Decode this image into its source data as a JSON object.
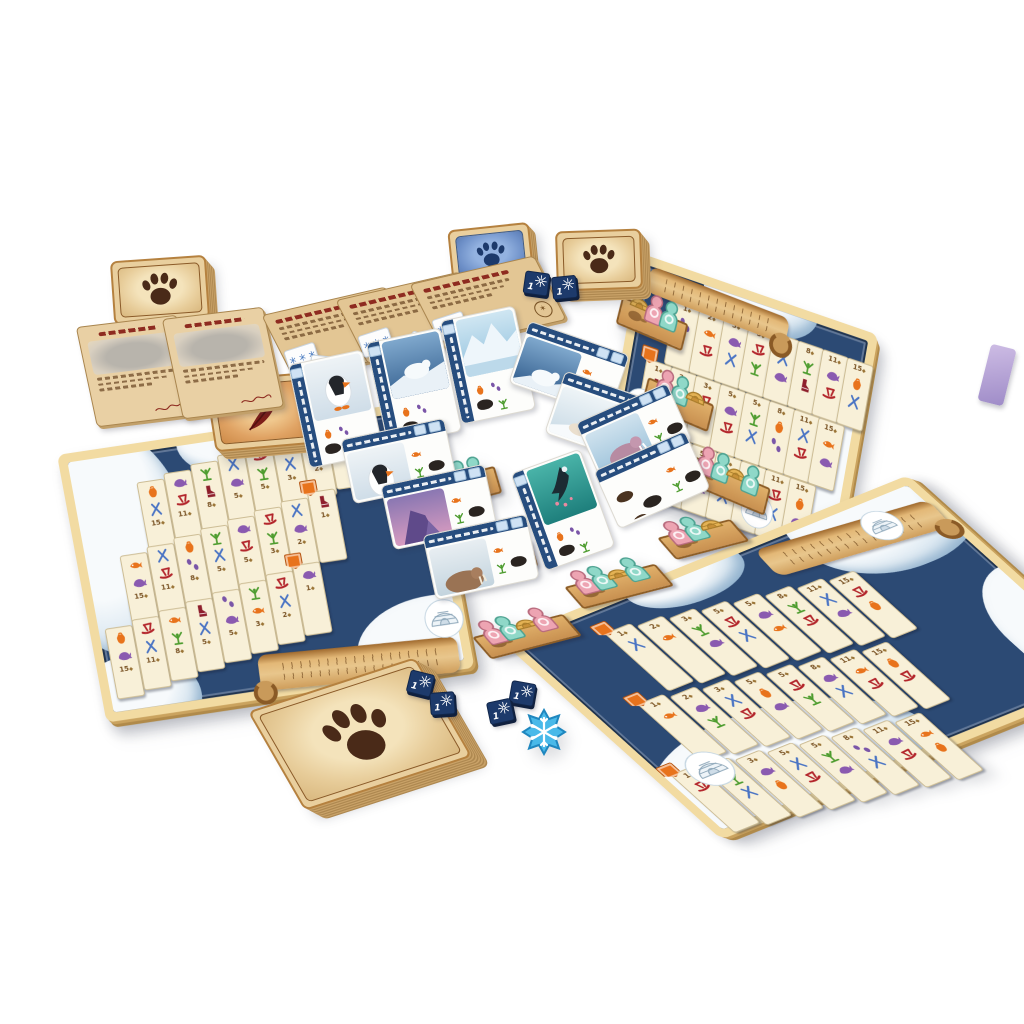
{
  "palette": {
    "board_frame": "#f2dba2",
    "water": "#2c4a74",
    "strip_bg": "#f8f0d8",
    "wood": "#d49e58",
    "sled": "#b3252b",
    "skis": "#4a74c4",
    "fish": "#e8731c",
    "whale": "#8a5ab0",
    "catch": "#4d9c2e",
    "boot": "#8e1f2c",
    "steps": "#7a55a8",
    "bag": "#e8731c",
    "paw": "#4a2a18",
    "feather": "#7e1f1a",
    "blue_emblem": "#1d3a6b",
    "meeple_pink": "#eda4b2",
    "meeple_mint": "#8fd8c8",
    "meeple_gold": "#e4b254",
    "navy_token": "#1d3a6b",
    "snow_token": "#49b9e9"
  },
  "decks": {
    "paw_top_left": {
      "back_icon": "paw-icon"
    },
    "paw_right": {
      "back_icon": "paw-icon"
    },
    "paw_bottom": {
      "back_icon": "paw-icon"
    },
    "feather": {
      "back_icon": "feather-icon"
    },
    "blue": {
      "back_icon": "blue-deck-emblem-icon"
    }
  },
  "guide_cards": [
    {
      "art": "walrus-sketch"
    },
    {
      "art": "seal-sketch"
    }
  ],
  "objective_cards": [
    {
      "stamp_icon": "snowflake-icon",
      "mini_snowflake_cards": 2
    },
    {
      "stamp_icon": "snowflake-icon",
      "mini_snowflake_cards": 3
    },
    {
      "stamp_icon": "snowflake-icon",
      "mini_snowflake_cards": 3
    }
  ],
  "market_cards": [
    {
      "art": "puffin"
    },
    {
      "art": "polar-bear"
    },
    {
      "art": "iceberg"
    }
  ],
  "boards": {
    "left": {
      "rows": [
        [
          {
            "v": 15,
            "i": [
              "bag",
              "skis"
            ]
          },
          {
            "v": 11,
            "i": [
              "whale",
              "sled"
            ]
          },
          {
            "v": 8,
            "i": [
              "catch",
              "boot"
            ]
          },
          {
            "v": 5,
            "i": [
              "skis",
              "whale"
            ]
          },
          {
            "v": 5,
            "i": [
              "sled",
              "catch"
            ]
          },
          {
            "v": 3,
            "i": [
              "whale",
              "skis"
            ]
          },
          {
            "v": 2,
            "i": [
              "fish",
              "sled"
            ]
          },
          {
            "v": 1,
            "i": [
              "steps"
            ]
          }
        ],
        [
          {
            "v": 15,
            "i": [
              "fish",
              "whale"
            ]
          },
          {
            "v": 11,
            "i": [
              "skis",
              "sled"
            ]
          },
          {
            "v": 8,
            "i": [
              "bag",
              "steps"
            ]
          },
          {
            "v": 5,
            "i": [
              "catch",
              "skis"
            ]
          },
          {
            "v": 5,
            "i": [
              "whale",
              "sled"
            ]
          },
          {
            "v": 3,
            "i": [
              "sled",
              "catch"
            ]
          },
          {
            "v": 2,
            "i": [
              "skis",
              "whale"
            ]
          },
          {
            "v": 1,
            "i": [
              "boot"
            ]
          }
        ],
        [
          {
            "v": 15,
            "i": [
              "bag",
              "whale"
            ]
          },
          {
            "v": 11,
            "i": [
              "sled",
              "skis"
            ]
          },
          {
            "v": 8,
            "i": [
              "fish",
              "catch"
            ]
          },
          {
            "v": 5,
            "i": [
              "boot",
              "skis"
            ]
          },
          {
            "v": 5,
            "i": [
              "steps",
              "whale"
            ]
          },
          {
            "v": 3,
            "i": [
              "catch",
              "fish"
            ]
          },
          {
            "v": 2,
            "i": [
              "sled",
              "skis"
            ]
          },
          {
            "v": 1,
            "i": [
              "whale"
            ]
          }
        ]
      ],
      "ledges": [
        [
          "pink",
          "mint"
        ],
        [
          "pink",
          "mint",
          "mint"
        ],
        [
          "pink",
          "mint",
          "gold"
        ]
      ],
      "cards": [
        {
          "art": "puffin"
        },
        {
          "art": "purple-rock"
        },
        {
          "art": "walrus"
        }
      ]
    },
    "right": {
      "rows": [
        [
          {
            "v": 1,
            "i": [
              "steps"
            ]
          },
          {
            "v": 2,
            "i": [
              "fish",
              "sled"
            ]
          },
          {
            "v": 3,
            "i": [
              "whale",
              "skis"
            ]
          },
          {
            "v": 5,
            "i": [
              "sled",
              "catch"
            ]
          },
          {
            "v": 5,
            "i": [
              "skis",
              "whale"
            ]
          },
          {
            "v": 8,
            "i": [
              "catch",
              "boot"
            ]
          },
          {
            "v": 11,
            "i": [
              "whale",
              "sled"
            ]
          },
          {
            "v": 15,
            "i": [
              "bag",
              "skis"
            ]
          }
        ],
        [
          {
            "v": 1,
            "i": [
              "boot"
            ]
          },
          {
            "v": 2,
            "i": [
              "skis",
              "whale"
            ]
          },
          {
            "v": 3,
            "i": [
              "sled",
              "catch"
            ]
          },
          {
            "v": 5,
            "i": [
              "whale",
              "sled"
            ]
          },
          {
            "v": 5,
            "i": [
              "catch",
              "skis"
            ]
          },
          {
            "v": 8,
            "i": [
              "bag",
              "steps"
            ]
          },
          {
            "v": 11,
            "i": [
              "skis",
              "sled"
            ]
          },
          {
            "v": 15,
            "i": [
              "fish",
              "whale"
            ]
          }
        ],
        [
          {
            "v": 1,
            "i": [
              "whale"
            ]
          },
          {
            "v": 2,
            "i": [
              "sled",
              "skis"
            ]
          },
          {
            "v": 3,
            "i": [
              "catch",
              "fish"
            ]
          },
          {
            "v": 5,
            "i": [
              "steps",
              "whale"
            ]
          },
          {
            "v": 5,
            "i": [
              "boot",
              "skis"
            ]
          },
          {
            "v": 8,
            "i": [
              "fish",
              "catch"
            ]
          },
          {
            "v": 11,
            "i": [
              "sled",
              "skis"
            ]
          },
          {
            "v": 15,
            "i": [
              "bag",
              "whale"
            ]
          }
        ]
      ],
      "ledges": [
        [
          "gold",
          "pink",
          "mint"
        ],
        [
          "pink",
          "mint",
          "gold"
        ],
        [
          "pink",
          "mint",
          "gold",
          "mint"
        ]
      ],
      "cards": [
        {
          "art": "polar-bear"
        },
        {
          "art": "ice-fox"
        }
      ]
    },
    "bottom_right": {
      "rows": [
        [
          {
            "v": 1,
            "i": [
              "skis"
            ]
          },
          {
            "v": 2,
            "i": [
              "fish"
            ]
          },
          {
            "v": 3,
            "i": [
              "catch",
              "whale"
            ]
          },
          {
            "v": 5,
            "i": [
              "sled",
              "skis"
            ]
          },
          {
            "v": 5,
            "i": [
              "whale",
              "fish"
            ]
          },
          {
            "v": 8,
            "i": [
              "catch",
              "sled"
            ]
          },
          {
            "v": 11,
            "i": [
              "skis",
              "whale"
            ]
          },
          {
            "v": 15,
            "i": [
              "sled",
              "bag"
            ]
          }
        ],
        [
          {
            "v": 1,
            "i": [
              "fish"
            ]
          },
          {
            "v": 2,
            "i": [
              "whale",
              "catch"
            ]
          },
          {
            "v": 3,
            "i": [
              "skis",
              "sled"
            ]
          },
          {
            "v": 5,
            "i": [
              "bag",
              "whale"
            ]
          },
          {
            "v": 5,
            "i": [
              "sled",
              "catch"
            ]
          },
          {
            "v": 8,
            "i": [
              "whale",
              "skis"
            ]
          },
          {
            "v": 11,
            "i": [
              "fish",
              "sled"
            ]
          },
          {
            "v": 15,
            "i": [
              "bag",
              "sled"
            ]
          }
        ],
        [
          {
            "v": 1,
            "i": [
              "sled"
            ]
          },
          {
            "v": 2,
            "i": [
              "catch",
              "skis"
            ]
          },
          {
            "v": 3,
            "i": [
              "whale",
              "bag"
            ]
          },
          {
            "v": 5,
            "i": [
              "skis",
              "sled"
            ]
          },
          {
            "v": 5,
            "i": [
              "catch",
              "whale"
            ]
          },
          {
            "v": 8,
            "i": [
              "steps",
              "skis"
            ]
          },
          {
            "v": 11,
            "i": [
              "whale",
              "sled"
            ]
          },
          {
            "v": 15,
            "i": [
              "fish",
              "bag"
            ]
          }
        ]
      ],
      "ledges": [
        [
          "pink",
          "mint",
          "gold",
          "pink"
        ],
        [
          "pink",
          "mint",
          "gold",
          "mint"
        ],
        [
          "pink",
          "mint",
          "gold"
        ]
      ],
      "cards": [
        {
          "art": "walrus-pink"
        },
        {
          "art": "silhouettes"
        },
        {
          "art": "orca"
        }
      ]
    }
  },
  "tokens": {
    "navy_squares": [
      {
        "label": "1"
      },
      {
        "label": "1"
      },
      {
        "label": "1"
      },
      {
        "label": "1"
      },
      {
        "label": "1"
      },
      {
        "label": "1"
      }
    ],
    "snowflake_token": {
      "icon": "snowflake-icon"
    }
  }
}
